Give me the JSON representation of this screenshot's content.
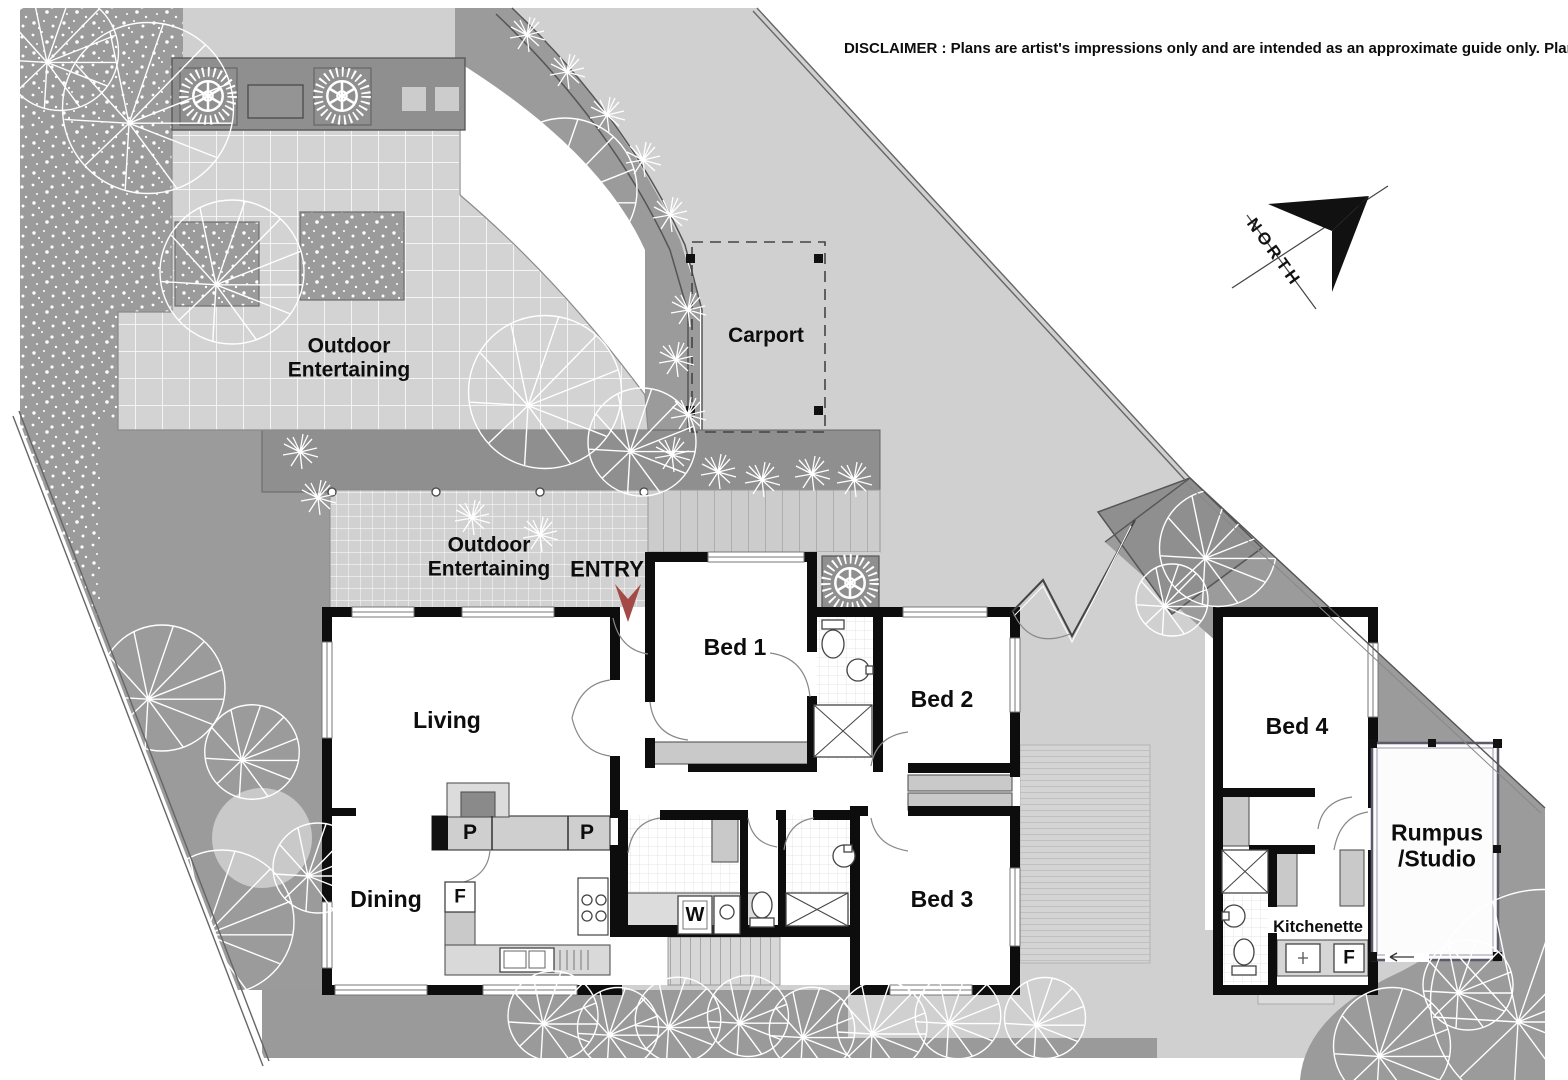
{
  "disclaimer": {
    "line1": "DISCLAIMER : Plans are artist's impressions only and are intended",
    "line2": "as an approximate guide only.  Plans may not be drawn to scale."
  },
  "compass": {
    "label": "NORTH"
  },
  "entry": {
    "label": "ENTRY"
  },
  "outdoor": {
    "area1_line1": "Outdoor",
    "area1_line2": "Entertaining",
    "area2_line1": "Outdoor",
    "area2_line2": "Entertaining",
    "carport": "Carport"
  },
  "rooms": {
    "living": "Living",
    "dining": "Dining",
    "bed1": "Bed 1",
    "bed2": "Bed 2",
    "bed3": "Bed 3",
    "bed4": "Bed 4",
    "rumpus_line1": "Rumpus",
    "rumpus_line2": "/Studio",
    "kitchenette": "Kitchenette"
  },
  "fixtures": {
    "pantry_left": "P",
    "pantry_right": "P",
    "fridge": "F",
    "washer": "W",
    "kitchenette_fridge": "F"
  },
  "colors": {
    "wall": "#0d0d0d",
    "paving": "#d3d3d3",
    "driveway": "#d0d0d0",
    "garden": "#9b9b9b",
    "garden_dark": "#8f8f8f",
    "entry_arrow": "#a44a46",
    "tree_outline": "#ffffff"
  }
}
